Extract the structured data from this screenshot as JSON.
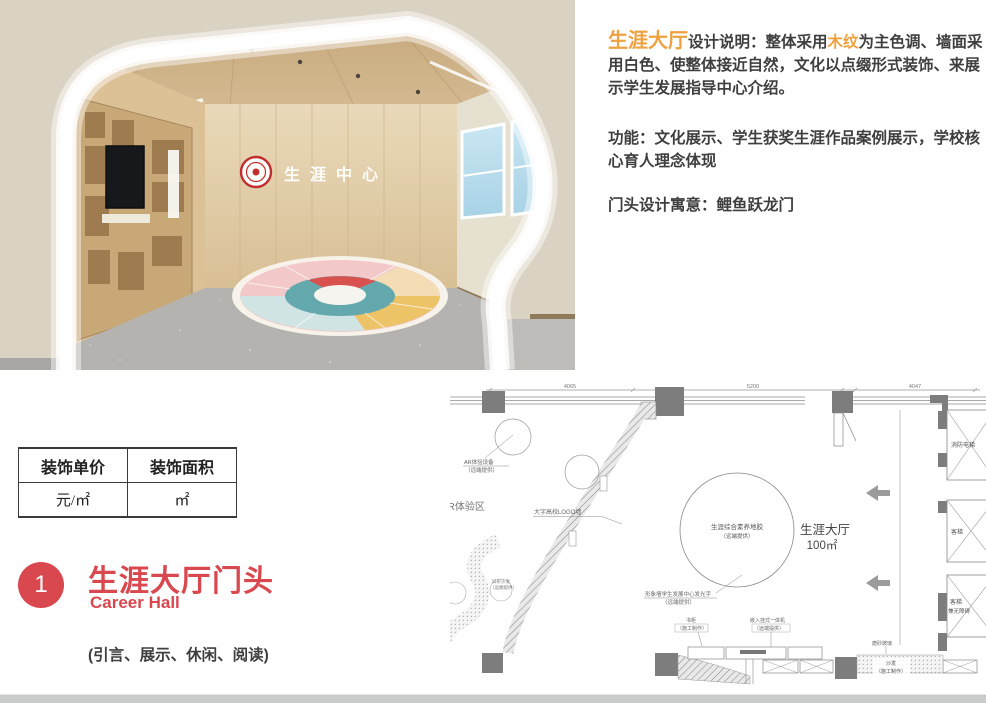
{
  "colors": {
    "accent_orange": "#EFA13F",
    "accent_red": "#D9474F",
    "text_dark": "#3F3F3F",
    "wood": "#D6BC96",
    "floor_gray": "#B4B3B0"
  },
  "render": {
    "logo_text": "生涯中心",
    "emblem": "school-emblem"
  },
  "description": {
    "p1_highlight": "生涯大厅",
    "p1_seg1": "设计说明：整体采用",
    "p1_highlight2": "木纹",
    "p1_seg2": "为主色调、墙面采用白色、使整体接近自然，文化以点缀形式装饰、来展示学生发展指导中心介绍。",
    "p2": "功能：文化展示、学生获奖生涯作品案例展示，学校核心育人理念体现",
    "p3": "门头设计寓意：鲤鱼跃龙门"
  },
  "price_table": {
    "headers": [
      "装饰单价",
      "装饰面积"
    ],
    "values": [
      "元/㎡",
      "㎡"
    ]
  },
  "section": {
    "number": "1",
    "title": "生涯大厅门头",
    "subtitle": "Career Hall",
    "note": "(引言、展示、休闲、阅读)"
  },
  "floorplan": {
    "dims": [
      "4065",
      "5200",
      "4047"
    ],
    "ar_line1": "AR体验设备",
    "ar_line2": "（远端提供）",
    "vr_zone": "VR体验区",
    "logo_wall": "大字高校LOGO墙",
    "decal_line1": "生涯综合素养地胶",
    "decal_line2": "（远端提供）",
    "room_name": "生涯大厅",
    "room_area": "100㎡",
    "shaped_sofa_line1": "异形沙发",
    "shaped_sofa_line2": "（远端提供）",
    "image_wall_line1": "形象墙学生发展中心发光字",
    "image_wall_line2": "（远端提供）",
    "bookcase_line1": "书柜",
    "bookcase_line2": "（施工制作）",
    "allinone_line1": "嵌入挂式一体机",
    "allinone_line2": "（远端提供）",
    "frosted_glass": "磨砂玻璃",
    "sofa_line1": "沙发",
    "sofa_line2": "（施工制作）",
    "elev_fire": "消防电梯",
    "elev_passenger": "客梯",
    "elev_acc_line1": "客梯",
    "elev_acc_line2": "兼无障碍"
  }
}
